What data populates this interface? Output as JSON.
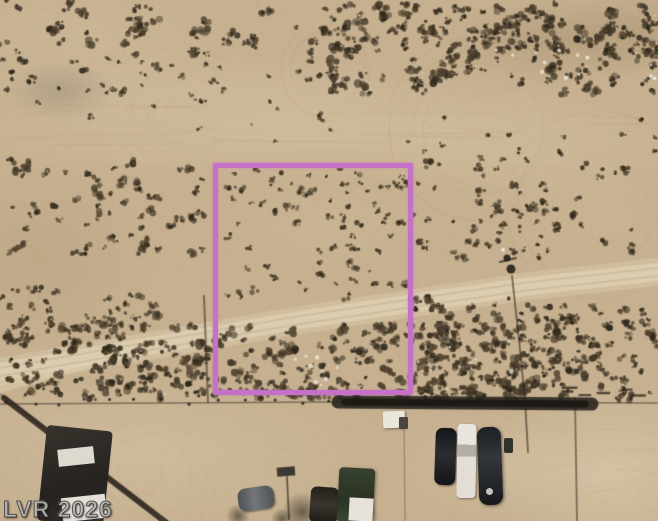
{
  "image": {
    "type_label": "aerial-parcel-satellite-photo",
    "watermark": "LVR 2026",
    "boundary_color": "#c671c8",
    "palette": {
      "sand_base": "#c6b090",
      "sand_light": "#d9c9ab",
      "sand_lighter": "#ddcfb2",
      "sand_dark": "#a98f6d",
      "shrub_dark": "#3f3524",
      "shrub_mid": "#584a36",
      "shrub_deep": "#2c2619",
      "shadow": "#211c15",
      "road_dark": "#26221b",
      "white_debris": "#efece2"
    }
  },
  "overlays": {
    "parcel_boundary": {
      "x": 213,
      "y": 163,
      "width": 200,
      "height": 232,
      "stroke_px": 5
    }
  }
}
